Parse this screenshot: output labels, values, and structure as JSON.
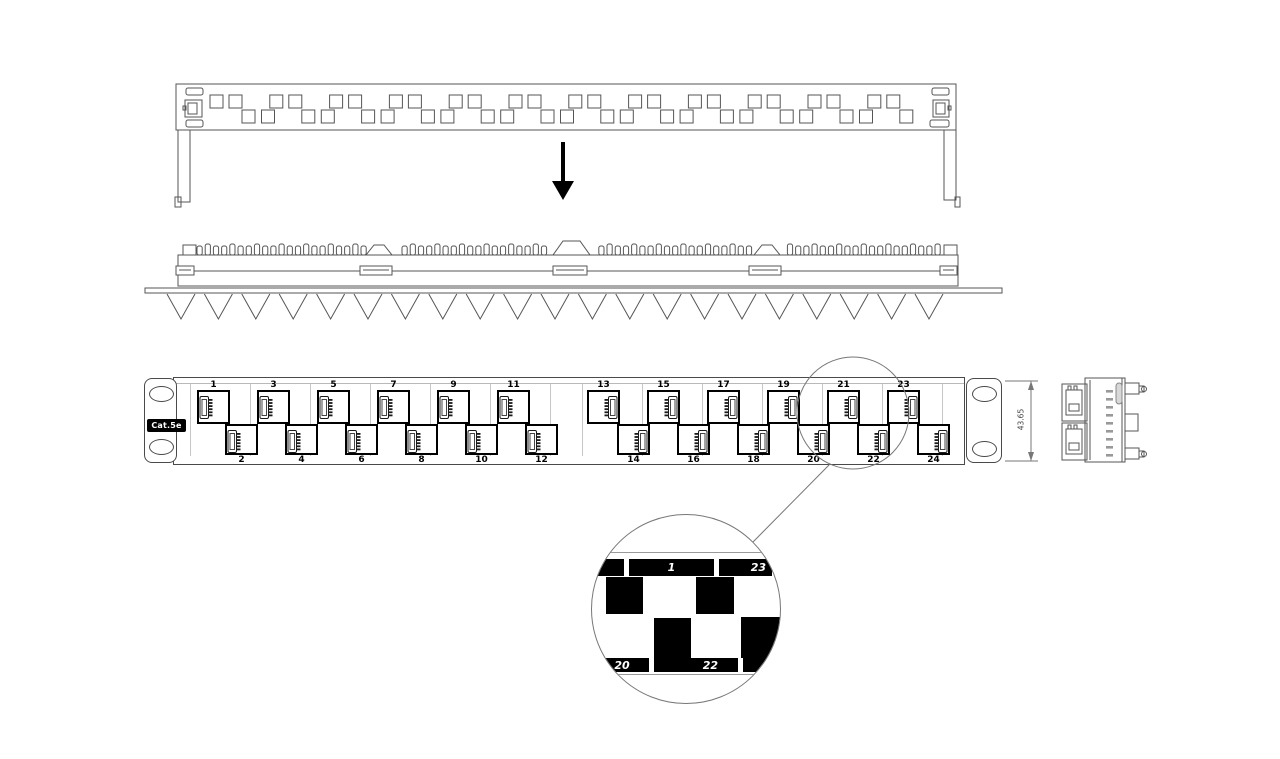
{
  "front_panel": {
    "category_label": "Cat.5e",
    "top_port_numbers": [
      "1",
      "3",
      "5",
      "7",
      "9",
      "11",
      "13",
      "15",
      "17",
      "19",
      "21",
      "23"
    ],
    "bottom_port_numbers": [
      "2",
      "4",
      "6",
      "8",
      "10",
      "12",
      "14",
      "16",
      "18",
      "20",
      "22",
      "24"
    ]
  },
  "dimension": {
    "panel_height": "43.65"
  },
  "detail_view": {
    "top_numbers": [
      "1",
      "23"
    ],
    "bottom_numbers": [
      "20",
      "22"
    ]
  },
  "colors": {
    "line": "#555555",
    "outline_dark": "#000000",
    "label_bg": "#000000",
    "label_text": "#ffffff",
    "background": "#ffffff"
  }
}
